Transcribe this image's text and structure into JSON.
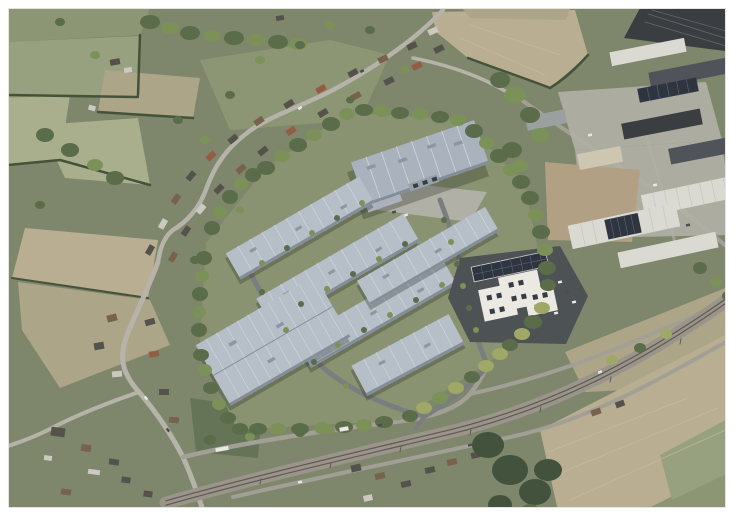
{
  "meta": {
    "image_type": "aerial-photomontage",
    "subject": "CGI visualisation of a proposed industrial / logistics park rendered onto an oblique aerial photograph of countryside, a village and an existing industrial estate",
    "border": "white frame around the photograph"
  },
  "palette": {
    "frame-bg": "#ffffff",
    "photo-edge": "#e4e4e2",
    "base-green": "#7e876c",
    "field-olive": "#97a07f",
    "field-pale": "#a9ae8c",
    "field-tan": "#b9ae92",
    "field-tan2": "#ada588",
    "field-green-light": "#8d9674",
    "paddock-green": "#657456",
    "hedge-dark": "#45523a",
    "tree-green": "#5a6c4a",
    "tree-light": "#7c9158",
    "tree-autumn": "#9fa866",
    "woods-dark": "#42523c",
    "road-light": "#b6b3a8",
    "road-mid": "#a29f95",
    "site-road": "#7b7e7e",
    "rail-bed": "#9a948a",
    "rail-track": "#5e5b54",
    "roof-light": "#b6bec8",
    "roof-mid": "#a9b2bd",
    "roof-ridge": "#ccd3da",
    "roof-edge": "#848e99",
    "roof-vent": "#8d96a1",
    "wall-gray": "#98a1aa",
    "yard-dark": "#4d5255",
    "office-white": "#ebe9e2",
    "window-dark": "#363c42",
    "solar-dark": "#2e3540",
    "solar-line": "#55606e",
    "house-dark": "#55524b",
    "house-brown": "#77624e",
    "house-red": "#955c44",
    "house-white": "#cbc9c0",
    "ind-white": "#dbdad2",
    "ind-beige": "#cdc6b1",
    "ind-dark": "#3a3e41",
    "ind-dark2": "#50545a",
    "ind-gray": "#9aa09e",
    "ind-line": "#63676c",
    "white-line": "#c9c8c0",
    "field-line": "#c3baa2",
    "concrete": "#b1b0a6",
    "dirt": "#b2a084",
    "shadow": "rgba(35,42,32,0.30)",
    "car-white": "#e8e8e4",
    "car-dark": "#4a4e52"
  },
  "scene": {
    "development": {
      "label": "proposed-business-park",
      "top_warehouse": "large warehouse at the north of the site",
      "terrace_unit_rows": 4,
      "southwest_warehouse": "large warehouse mass at the south-west corner",
      "southeast_unit": "smaller unit row near the south-east corner",
      "office": "white office building with rooftop solar array on dark asphalt yard",
      "landscaping": "dense perimeter tree buffer and tree-lined internal access roads"
    },
    "surroundings": {
      "village_northwest": "houses and gardens along a curving rural road",
      "industrial_estate_east": "existing sheds, solar roofs, concrete yards and a dirt laydown area",
      "railway": "double-track railway corridor crossing the south-east on a diagonal",
      "fields": "arable (tan, ploughed) and pasture (green) fields with dark hedgerows",
      "roads": "rural roads meeting at a junction near the south-west with a white bus"
    }
  }
}
